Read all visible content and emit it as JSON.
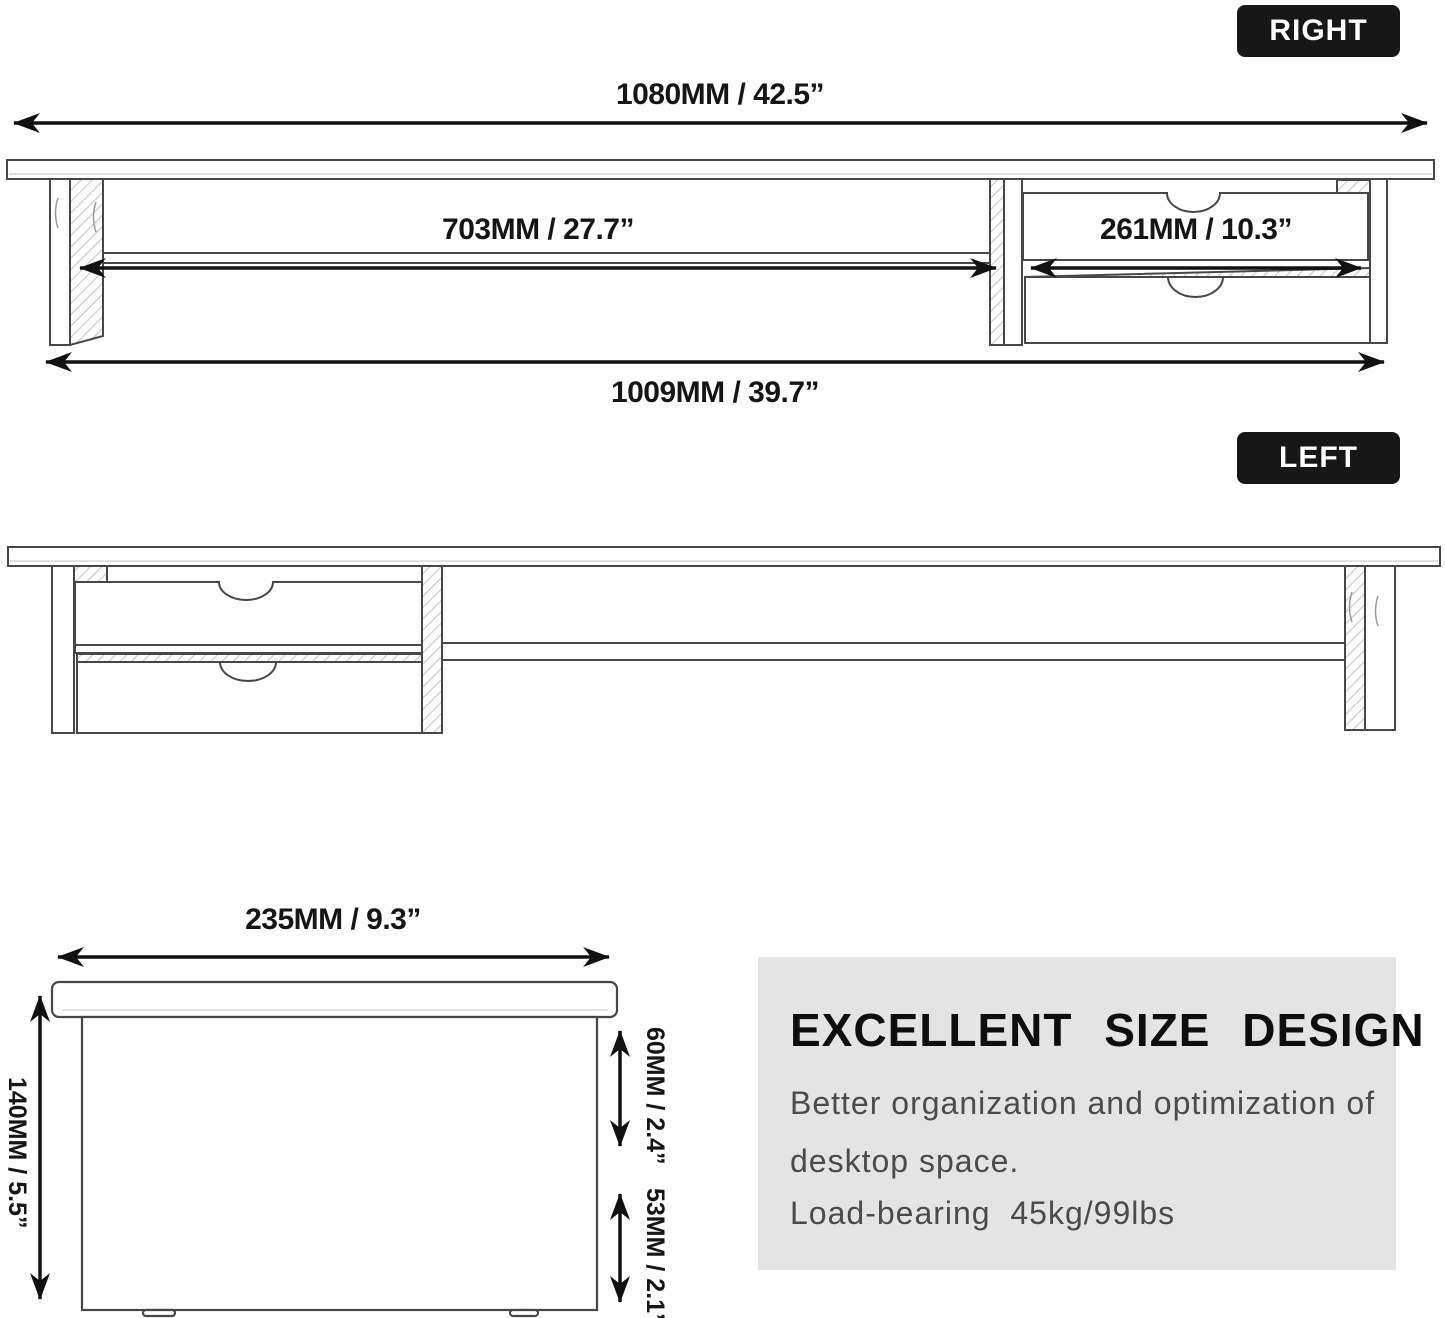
{
  "badges": {
    "right": "RIGHT",
    "left": "LEFT"
  },
  "top_view_right": {
    "label_total_top": "1080MM / 42.5”",
    "label_shelf": "703MM / 27.7”",
    "label_drawer": "261MM / 10.3”",
    "label_total_bottom": "1009MM / 39.7”"
  },
  "side_view": {
    "label_depth": "235MM / 9.3”",
    "label_height": "140MM / 5.5”",
    "label_upper": "60MM / 2.4”",
    "label_lower": "53MM / 2.1”"
  },
  "info_box": {
    "heading": "EXCELLENT SIZE DESIGN",
    "line1": "Better organization and optimization of",
    "line2": "desktop space.",
    "line3": "Load-bearing  45kg/99lbs",
    "background": "#e5e4e4"
  },
  "colors": {
    "badge_bg": "#171717",
    "badge_text": "#ffffff",
    "dimension_text": "#161616",
    "arrow": "#111111",
    "line_art": "#474747",
    "body_text": "#4b4b4b"
  }
}
